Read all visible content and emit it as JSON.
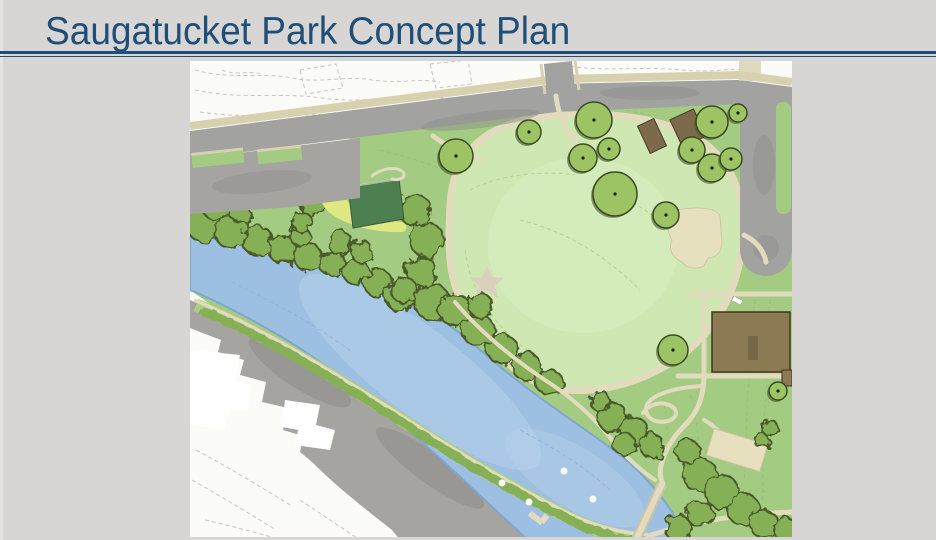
{
  "slide": {
    "title": "Saugatucket Park Concept Plan"
  },
  "colors": {
    "background": "#d7d6d4",
    "slide_edge": "#e4e3e1",
    "title": "#1f4e79",
    "rule": "#1f4e79",
    "map_white": "#fbfbf7",
    "contour": "#c9c6bf",
    "contour_green": "#9dbc7c",
    "park_green": "#a3cb81",
    "lawn": "#cfe8b3",
    "lawn_light": "#daf0c4",
    "canopy": "#86b054",
    "canopy_dark": "#4a5a2c",
    "tree": "#9cc464",
    "tree_edge": "#3c4a24",
    "pond": "#9dc0e2",
    "pond_light": "#b8d1ea",
    "pond_edge": "#7fa6cf",
    "pond_contour": "#8cb0d6",
    "road": "#a2a2a0",
    "road_dark": "#8d8d8b",
    "sidewalk": "#d8d1b0",
    "path": "#e2dbbe",
    "path_dark": "#cbc3a6",
    "sand": "#dfe883",
    "green_roof": "#4d7f50",
    "pavilion_brown": "#7d6a4a",
    "building_brown": "#8c7a54",
    "building_edge": "#3f3420",
    "building_tan": "#e7e0bf",
    "parking": "#a6a4a1",
    "parking_dark": "#8a8885",
    "white": "#ffffff"
  },
  "map": {
    "features": [
      "contour-lines",
      "street",
      "street-sidewalk",
      "street-parking-apron",
      "planted-medians",
      "cul-de-sac",
      "great-lawn",
      "lawn-loop-path",
      "lawn-star-marker",
      "beach-sand",
      "green-roof-building",
      "picnic-pavilions",
      "tan-building",
      "large-brown-building",
      "sports-court",
      "pond",
      "foot-bridge",
      "shoreline-trail",
      "tree-canopy",
      "individual-trees",
      "neighboring-buildings",
      "parking-lot",
      "dock"
    ],
    "trees": [
      {
        "x": 456,
        "y": 156,
        "r": 17
      },
      {
        "x": 529,
        "y": 132,
        "r": 12
      },
      {
        "x": 594,
        "y": 120,
        "r": 18
      },
      {
        "x": 583,
        "y": 158,
        "r": 14
      },
      {
        "x": 609,
        "y": 149,
        "r": 11
      },
      {
        "x": 615,
        "y": 194,
        "r": 22
      },
      {
        "x": 666,
        "y": 215,
        "r": 13
      },
      {
        "x": 712,
        "y": 122,
        "r": 16
      },
      {
        "x": 738,
        "y": 113,
        "r": 9
      },
      {
        "x": 692,
        "y": 150,
        "r": 13
      },
      {
        "x": 712,
        "y": 168,
        "r": 14
      },
      {
        "x": 731,
        "y": 159,
        "r": 11
      },
      {
        "x": 673,
        "y": 350,
        "r": 15
      },
      {
        "x": 778,
        "y": 391,
        "r": 9
      }
    ],
    "buoys": [
      {
        "x": 502,
        "y": 483
      },
      {
        "x": 529,
        "y": 502
      },
      {
        "x": 564,
        "y": 471
      },
      {
        "x": 593,
        "y": 499
      }
    ]
  }
}
